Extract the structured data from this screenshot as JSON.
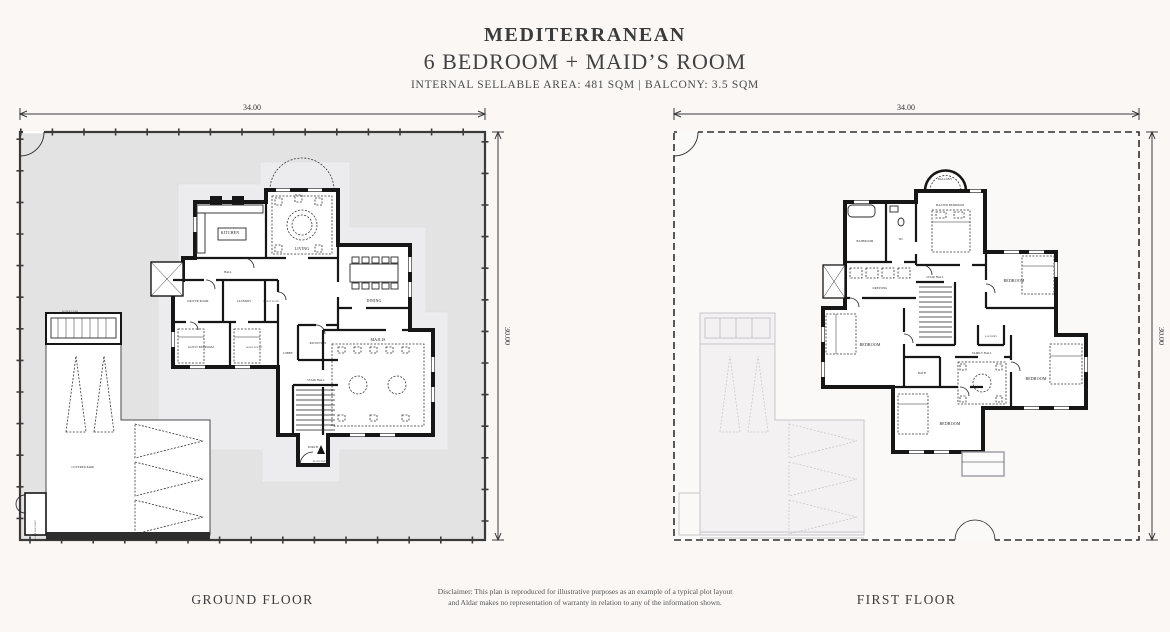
{
  "header": {
    "title": "MEDITERRANEAN",
    "subtitle": "6 BEDROOM + MAID’S ROOM",
    "area_line": "INTERNAL SELLABLE AREA: 481 SQM | BALCONY: 3.5 SQM"
  },
  "ground_floor": {
    "label": "GROUND FLOOR",
    "dims": {
      "width": "34.00",
      "height": "30.00"
    },
    "rooms": {
      "kitchen": "KITCHEN",
      "living": "LIVING",
      "dining": "DINING",
      "majlis": "MAJLIS",
      "reception": "RECEPTION",
      "hall": "HALL",
      "lobby": "LOBBY",
      "porch": "PORCH",
      "main_entry": "MAIN ENTRY",
      "stair": "STAIR HALL",
      "driver": "DRIVER ROOM",
      "laundry": "LAUNDRY",
      "guest_bedroom": "GUEST BEDROOM",
      "guest_bath": "GUEST BATH",
      "maid": "MAID ROOM",
      "water_tank": "WATER TANK",
      "covered_park": "COVERED PARK",
      "garbage": "GARBAGE UNIT"
    }
  },
  "first_floor": {
    "label": "FIRST FLOOR",
    "dims": {
      "width": "34.00",
      "height": "30.00"
    },
    "rooms": {
      "balcony": "BALCONY",
      "master": "MASTER BEDROOM",
      "bathroom": "BATHROOM",
      "wc": "WC",
      "dressing": "DRESSING",
      "stair": "STAIR HALL",
      "bedroom_a": "BEDROOM",
      "bedroom_b": "BEDROOM",
      "bedroom_c": "BEDROOM",
      "bedroom_d": "BEDROOM",
      "family": "FAMILY HALL",
      "bath": "BATH",
      "laundry": "LAUNDRY"
    }
  },
  "disclaimer": {
    "line1": "Disclaimer: This plan is reproduced for illustrative purposes as an example of a typical plot layout",
    "line2": "and Aldar makes no representation of warranty in relation to any of the information shown."
  },
  "colors": {
    "background": "#faf7f5",
    "plot_fill": "#e3e3e4",
    "setback_fill": "#ececee",
    "wall": "#161616",
    "ghost": "#c6c6ca"
  }
}
